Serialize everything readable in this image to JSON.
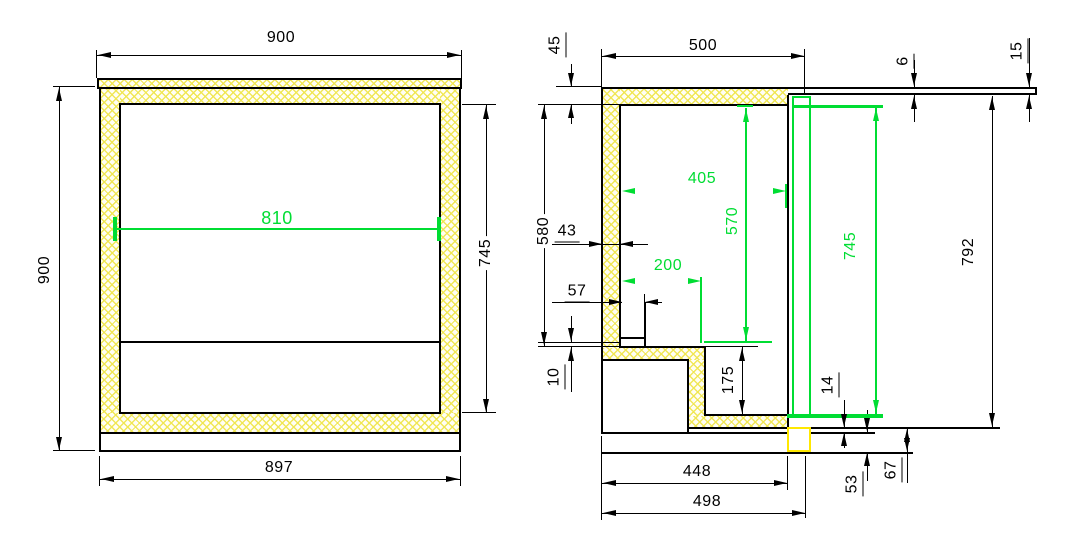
{
  "meta": {
    "canvas_width": 1081,
    "canvas_height": 551,
    "description": "CAD cross-section drawing, two views of an insulated counter cabinet with dimension annotations"
  },
  "colors": {
    "line": "#000000",
    "dimension_green": "#00dd33",
    "hatch_yellow": "#f0e650",
    "marker_yellow": "#ffe800",
    "background": "#ffffff"
  },
  "left_view_values": [
    "900",
    "900",
    "810",
    "745",
    "897"
  ],
  "right_view_values": [
    "45",
    "500",
    "6",
    "15",
    "580",
    "43",
    "405",
    "570",
    "745",
    "792",
    "200",
    "57",
    "10",
    "175",
    "14",
    "53",
    "67",
    "448",
    "498"
  ],
  "hatches": [
    {
      "x": 99,
      "y": 80,
      "w": 362,
      "h": 7
    },
    {
      "x": 101,
      "y": 89,
      "w": 358,
      "h": 15
    },
    {
      "x": 101,
      "y": 89,
      "w": 19,
      "h": 344
    },
    {
      "x": 440,
      "y": 89,
      "w": 19,
      "h": 344
    },
    {
      "x": 101,
      "y": 413,
      "w": 358,
      "h": 20
    },
    {
      "x": 603,
      "y": 89,
      "w": 185,
      "h": 15
    },
    {
      "x": 603,
      "y": 89,
      "w": 17,
      "h": 271
    },
    {
      "x": 603,
      "y": 348,
      "w": 102,
      "h": 12
    },
    {
      "x": 689,
      "y": 360,
      "w": 16,
      "h": 56
    },
    {
      "x": 689,
      "y": 416,
      "w": 98,
      "h": 12
    }
  ],
  "lines": [
    {
      "x": 97,
      "y": 78,
      "w": 365,
      "h": 2
    },
    {
      "x": 97,
      "y": 87,
      "w": 365,
      "h": 2
    },
    {
      "x": 97,
      "y": 78,
      "w": 2,
      "h": 11
    },
    {
      "x": 460,
      "y": 78,
      "w": 2,
      "h": 11
    },
    {
      "x": 99,
      "y": 87,
      "w": 2,
      "h": 347
    },
    {
      "x": 459,
      "y": 87,
      "w": 2,
      "h": 347
    },
    {
      "x": 99,
      "y": 432,
      "w": 362,
      "h": 2
    },
    {
      "x": 119,
      "y": 103,
      "w": 322,
      "h": 2
    },
    {
      "x": 119,
      "y": 103,
      "w": 2,
      "h": 311
    },
    {
      "x": 439,
      "y": 103,
      "w": 2,
      "h": 311
    },
    {
      "x": 119,
      "y": 412,
      "w": 322,
      "h": 2
    },
    {
      "x": 120,
      "y": 341,
      "w": 320,
      "h": 2
    },
    {
      "x": 99,
      "y": 434,
      "w": 2,
      "h": 18
    },
    {
      "x": 459,
      "y": 434,
      "w": 2,
      "h": 18
    },
    {
      "x": 99,
      "y": 450,
      "w": 362,
      "h": 2
    },
    {
      "x": 97,
      "y": 55,
      "w": 365,
      "h": 1
    },
    {
      "x": 96,
      "y": 50,
      "w": 1,
      "h": 28
    },
    {
      "x": 461,
      "y": 50,
      "w": 1,
      "h": 28
    },
    {
      "x": 59,
      "y": 87,
      "w": 1,
      "h": 364
    },
    {
      "x": 53,
      "y": 86,
      "w": 42,
      "h": 1
    },
    {
      "x": 53,
      "y": 450,
      "w": 42,
      "h": 1
    },
    {
      "x": 486,
      "y": 105,
      "w": 1,
      "h": 308
    },
    {
      "x": 462,
      "y": 104,
      "w": 34,
      "h": 1
    },
    {
      "x": 462,
      "y": 412,
      "w": 34,
      "h": 1
    },
    {
      "x": 100,
      "y": 479,
      "w": 361,
      "h": 1
    },
    {
      "x": 99,
      "y": 456,
      "w": 1,
      "h": 30
    },
    {
      "x": 460,
      "y": 456,
      "w": 1,
      "h": 30
    },
    {
      "x": 115,
      "y": 228,
      "w": 325,
      "h": 2,
      "c": "g"
    },
    {
      "x": 113,
      "y": 217,
      "w": 4,
      "h": 24,
      "c": "g"
    },
    {
      "x": 437,
      "y": 217,
      "w": 4,
      "h": 24,
      "c": "g"
    },
    {
      "x": 602,
      "y": 87,
      "w": 435,
      "h": 2
    },
    {
      "x": 788,
      "y": 93,
      "w": 249,
      "h": 2
    },
    {
      "x": 1035,
      "y": 87,
      "w": 2,
      "h": 8
    },
    {
      "x": 620,
      "y": 104,
      "w": 168,
      "h": 2
    },
    {
      "x": 601,
      "y": 87,
      "w": 2,
      "h": 347
    },
    {
      "x": 619,
      "y": 104,
      "w": 2,
      "h": 244
    },
    {
      "x": 620,
      "y": 346,
      "w": 86,
      "h": 2
    },
    {
      "x": 704,
      "y": 346,
      "w": 2,
      "h": 70
    },
    {
      "x": 704,
      "y": 414,
      "w": 84,
      "h": 2
    },
    {
      "x": 787,
      "y": 95,
      "w": 2,
      "h": 334
    },
    {
      "x": 601,
      "y": 359,
      "w": 88,
      "h": 2
    },
    {
      "x": 687,
      "y": 359,
      "w": 2,
      "h": 75
    },
    {
      "x": 687,
      "y": 427,
      "w": 313,
      "h": 2
    },
    {
      "x": 601,
      "y": 432,
      "w": 274,
      "h": 2
    },
    {
      "x": 601,
      "y": 452,
      "w": 312,
      "h": 2
    },
    {
      "x": 644,
      "y": 302,
      "w": 2,
      "h": 45
    },
    {
      "x": 620,
      "y": 337,
      "w": 26,
      "h": 2
    },
    {
      "x": 602,
      "y": 56,
      "w": 203,
      "h": 1
    },
    {
      "x": 601,
      "y": 49,
      "w": 1,
      "h": 38
    },
    {
      "x": 804,
      "y": 49,
      "w": 1,
      "h": 44
    },
    {
      "x": 571,
      "y": 64,
      "w": 1,
      "h": 23
    },
    {
      "x": 571,
      "y": 104,
      "w": 1,
      "h": 20
    },
    {
      "x": 556,
      "y": 86,
      "w": 46,
      "h": 1
    },
    {
      "x": 538,
      "y": 104,
      "w": 82,
      "h": 1
    },
    {
      "x": 544,
      "y": 105,
      "w": 1,
      "h": 241
    },
    {
      "x": 538,
      "y": 346,
      "w": 82,
      "h": 1
    },
    {
      "x": 538,
      "y": 342,
      "w": 83,
      "h": 1
    },
    {
      "x": 552,
      "y": 244,
      "w": 96,
      "h": 1
    },
    {
      "x": 552,
      "y": 302,
      "w": 70,
      "h": 1
    },
    {
      "x": 645,
      "y": 302,
      "w": 17,
      "h": 1
    },
    {
      "x": 644,
      "y": 294,
      "w": 1,
      "h": 8
    },
    {
      "x": 571,
      "y": 316,
      "w": 1,
      "h": 26
    },
    {
      "x": 571,
      "y": 347,
      "w": 1,
      "h": 45
    },
    {
      "x": 742,
      "y": 347,
      "w": 1,
      "h": 67
    },
    {
      "x": 706,
      "y": 346,
      "w": 52,
      "h": 1
    },
    {
      "x": 914,
      "y": 60,
      "w": 1,
      "h": 27
    },
    {
      "x": 914,
      "y": 95,
      "w": 1,
      "h": 27
    },
    {
      "x": 1029,
      "y": 38,
      "w": 1,
      "h": 49
    },
    {
      "x": 1029,
      "y": 95,
      "w": 1,
      "h": 27
    },
    {
      "x": 992,
      "y": 96,
      "w": 1,
      "h": 331
    },
    {
      "x": 844,
      "y": 400,
      "w": 1,
      "h": 28
    },
    {
      "x": 844,
      "y": 433,
      "w": 1,
      "h": 15
    },
    {
      "x": 867,
      "y": 410,
      "w": 1,
      "h": 22
    },
    {
      "x": 867,
      "y": 453,
      "w": 1,
      "h": 28
    },
    {
      "x": 907,
      "y": 428,
      "w": 1,
      "h": 55
    },
    {
      "x": 602,
      "y": 483,
      "w": 186,
      "h": 1
    },
    {
      "x": 787,
      "y": 456,
      "w": 1,
      "h": 34
    },
    {
      "x": 601,
      "y": 436,
      "w": 1,
      "h": 84
    },
    {
      "x": 602,
      "y": 513,
      "w": 204,
      "h": 1
    },
    {
      "x": 805,
      "y": 456,
      "w": 1,
      "h": 62
    },
    {
      "x": 793,
      "y": 105,
      "w": 90,
      "h": 3,
      "c": "g"
    },
    {
      "x": 787,
      "y": 414,
      "w": 96,
      "h": 4,
      "c": "g"
    },
    {
      "x": 875,
      "y": 107,
      "w": 2,
      "h": 307,
      "c": "g"
    },
    {
      "x": 745,
      "y": 108,
      "w": 2,
      "h": 233,
      "c": "g"
    },
    {
      "x": 737,
      "y": 105,
      "w": 16,
      "h": 2,
      "c": "g"
    },
    {
      "x": 785,
      "y": 184,
      "w": 2,
      "h": 24,
      "c": "g"
    },
    {
      "x": 700,
      "y": 277,
      "w": 2,
      "h": 66,
      "c": "g"
    },
    {
      "x": 704,
      "y": 341,
      "w": 68,
      "h": 2,
      "c": "g"
    }
  ],
  "rects": [
    {
      "x": 792,
      "y": 96,
      "w": 19,
      "h": 322,
      "c": "g",
      "bw": 2,
      "fill": "none",
      "name": "door-panel"
    },
    {
      "x": 787,
      "y": 427,
      "w": 24,
      "h": 25,
      "c": "y",
      "bw": 2,
      "fill": "#ffffff",
      "name": "door-seal-marker"
    }
  ],
  "arrows": [
    {
      "x": 98,
      "y": 55,
      "d": "left"
    },
    {
      "x": 460,
      "y": 55,
      "d": "right"
    },
    {
      "x": 59,
      "y": 88,
      "d": "up"
    },
    {
      "x": 59,
      "y": 450,
      "d": "down"
    },
    {
      "x": 486,
      "y": 106,
      "d": "up"
    },
    {
      "x": 486,
      "y": 412,
      "d": "down"
    },
    {
      "x": 101,
      "y": 479,
      "d": "left"
    },
    {
      "x": 459,
      "y": 479,
      "d": "right"
    },
    {
      "x": 603,
      "y": 56,
      "d": "left"
    },
    {
      "x": 804,
      "y": 56,
      "d": "right"
    },
    {
      "x": 571,
      "y": 86,
      "d": "down"
    },
    {
      "x": 571,
      "y": 105,
      "d": "up"
    },
    {
      "x": 544,
      "y": 106,
      "d": "up"
    },
    {
      "x": 544,
      "y": 345,
      "d": "down"
    },
    {
      "x": 602,
      "y": 244,
      "d": "right"
    },
    {
      "x": 620,
      "y": 244,
      "d": "left"
    },
    {
      "x": 622,
      "y": 302,
      "d": "right"
    },
    {
      "x": 645,
      "y": 302,
      "d": "left"
    },
    {
      "x": 571,
      "y": 341,
      "d": "down"
    },
    {
      "x": 571,
      "y": 348,
      "d": "up"
    },
    {
      "x": 742,
      "y": 348,
      "d": "up"
    },
    {
      "x": 742,
      "y": 413,
      "d": "down"
    },
    {
      "x": 914,
      "y": 86,
      "d": "down"
    },
    {
      "x": 914,
      "y": 96,
      "d": "up"
    },
    {
      "x": 1029,
      "y": 86,
      "d": "down"
    },
    {
      "x": 1029,
      "y": 96,
      "d": "up"
    },
    {
      "x": 992,
      "y": 97,
      "d": "up"
    },
    {
      "x": 992,
      "y": 426,
      "d": "down"
    },
    {
      "x": 844,
      "y": 427,
      "d": "down"
    },
    {
      "x": 844,
      "y": 433,
      "d": "up"
    },
    {
      "x": 867,
      "y": 431,
      "d": "down"
    },
    {
      "x": 867,
      "y": 453,
      "d": "up"
    },
    {
      "x": 907,
      "y": 429,
      "d": "up"
    },
    {
      "x": 907,
      "y": 451,
      "d": "down"
    },
    {
      "x": 603,
      "y": 483,
      "d": "left"
    },
    {
      "x": 787,
      "y": 483,
      "d": "right"
    },
    {
      "x": 603,
      "y": 513,
      "d": "left"
    },
    {
      "x": 805,
      "y": 513,
      "d": "right"
    },
    {
      "x": 876,
      "y": 108,
      "d": "up",
      "c": "g"
    },
    {
      "x": 876,
      "y": 413,
      "d": "down",
      "c": "g"
    },
    {
      "x": 746,
      "y": 109,
      "d": "up",
      "c": "g"
    },
    {
      "x": 746,
      "y": 340,
      "d": "down",
      "c": "g"
    },
    {
      "x": 622,
      "y": 191,
      "d": "left",
      "c": "g"
    },
    {
      "x": 786,
      "y": 191,
      "d": "right",
      "c": "g"
    },
    {
      "x": 622,
      "y": 281,
      "d": "left",
      "c": "g"
    },
    {
      "x": 701,
      "y": 281,
      "d": "right",
      "c": "g"
    }
  ],
  "texts": [
    {
      "t": "900",
      "x": 281,
      "y": 38
    },
    {
      "t": "900",
      "x": 45,
      "y": 270,
      "rot": 1
    },
    {
      "t": "810",
      "x": 277,
      "y": 218,
      "c": "g",
      "s": 18
    },
    {
      "t": "745",
      "x": 486,
      "y": 253,
      "rot": 1,
      "bg": 1
    },
    {
      "t": "897",
      "x": 279,
      "y": 468
    },
    {
      "t": "500",
      "x": 703,
      "y": 46
    },
    {
      "t": "45",
      "x": 557,
      "y": 45,
      "rot": 1,
      "ul": 1
    },
    {
      "t": "6",
      "x": 905,
      "y": 61,
      "rot": 1,
      "ul": 1
    },
    {
      "t": "15",
      "x": 1019,
      "y": 51,
      "rot": 1,
      "ul": 1
    },
    {
      "t": "580",
      "x": 544,
      "y": 231,
      "rot": 1,
      "bg": 1
    },
    {
      "t": "43",
      "x": 567,
      "y": 233,
      "ul": 1
    },
    {
      "t": "405",
      "x": 702,
      "y": 179,
      "c": "g"
    },
    {
      "t": "570",
      "x": 733,
      "y": 221,
      "c": "g",
      "rot": 1
    },
    {
      "t": "745",
      "x": 851,
      "y": 246,
      "c": "g",
      "rot": 1
    },
    {
      "t": "792",
      "x": 969,
      "y": 252,
      "rot": 1,
      "bg": 1
    },
    {
      "t": "200",
      "x": 668,
      "y": 266,
      "c": "g"
    },
    {
      "t": "57",
      "x": 577,
      "y": 293,
      "ul": 1
    },
    {
      "t": "10",
      "x": 556,
      "y": 377,
      "rot": 1,
      "ul": 1
    },
    {
      "t": "175",
      "x": 729,
      "y": 380,
      "rot": 1
    },
    {
      "t": "14",
      "x": 830,
      "y": 385,
      "rot": 1,
      "ul": 1
    },
    {
      "t": "53",
      "x": 854,
      "y": 484,
      "rot": 1,
      "ul": 1
    },
    {
      "t": "67",
      "x": 893,
      "y": 470,
      "rot": 1,
      "ul": 1
    },
    {
      "t": "448",
      "x": 697,
      "y": 472
    },
    {
      "t": "498",
      "x": 707,
      "y": 502
    }
  ]
}
